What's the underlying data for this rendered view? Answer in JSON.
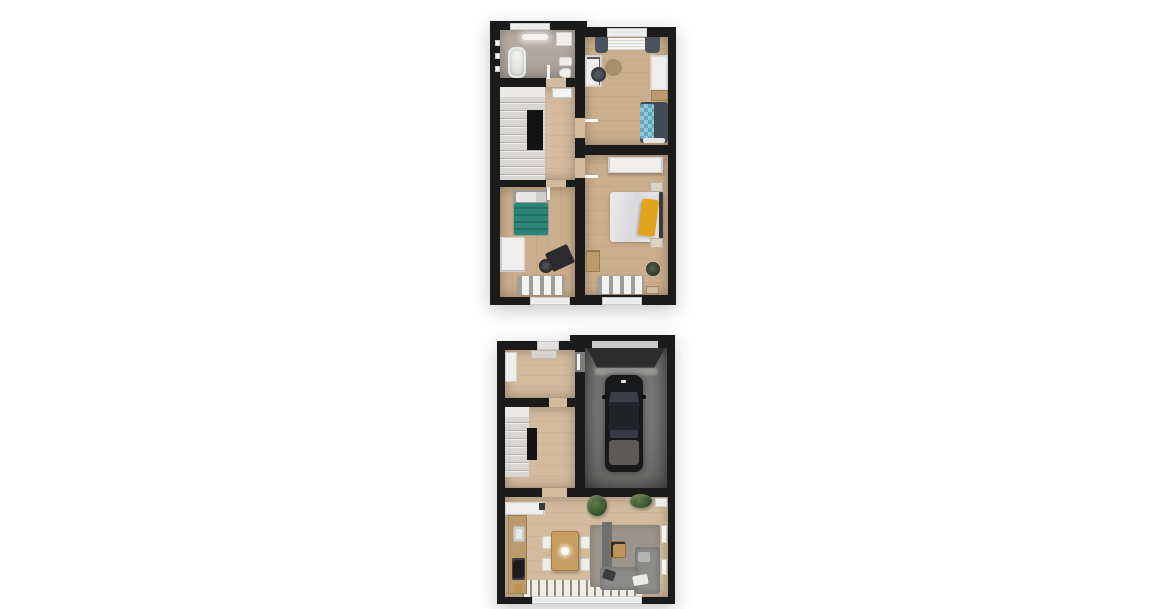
{
  "image_type": "3d-floor-plan-rendering",
  "background": "#ffffff",
  "colors": {
    "wall": "#1b1b1b",
    "wood-floor": "#cbae8d",
    "wood-floor-light": "#d3bb9d",
    "bathroom-floor": "#b1a8a0",
    "stairs": "#d8d6d2",
    "garage-floor": "#6f6f6d",
    "teal-bed": "#2c8577",
    "blue-checker-blanket": "#8fc7d9",
    "yellow-throw": "#e3a51f",
    "sofa-gray": "#8b8b89",
    "rug-gray": "#9b948c",
    "white-furniture": "#efeeec",
    "plant-green": "#47632f",
    "car-body": "#17181a"
  },
  "floors": [
    {
      "name": "upper-floor-plan",
      "rooms": [
        {
          "name": "bathroom",
          "furniture": [
            "bathtub",
            "vanity-cabinet",
            "sink",
            "toilet",
            "radiator",
            "window",
            "ceiling-light"
          ]
        },
        {
          "name": "landing",
          "furniture": [
            "staircase",
            "stairwell-void",
            "radiator"
          ]
        },
        {
          "name": "bedroom-with-teal-bed",
          "furniture": [
            "single-bed-teal",
            "wardrobe",
            "desk",
            "office-chair",
            "striped-rug",
            "window"
          ]
        },
        {
          "name": "bedroom-with-blue-checkered-bed",
          "furniture": [
            "bed-blue-checkered-blanket",
            "desk",
            "office-chair",
            "round-rug",
            "wardrobe",
            "dresser",
            "window-with-curtains"
          ]
        },
        {
          "name": "master-bedroom",
          "furniture": [
            "double-bed-yellow-throw",
            "headboard",
            "wardrobe",
            "nightstand-top",
            "nightstand-bottom",
            "dresser",
            "potted-plant",
            "striped-rug",
            "doormat",
            "window"
          ]
        }
      ]
    },
    {
      "name": "ground-floor-plan",
      "rooms": [
        {
          "name": "entrance-hall",
          "furniture": [
            "closet",
            "doormat",
            "front-door"
          ]
        },
        {
          "name": "staircase-hall",
          "furniture": [
            "stairs",
            "stair-wall"
          ]
        },
        {
          "name": "garage",
          "furniture": [
            "car",
            "garage-door"
          ]
        },
        {
          "name": "kitchen-living-room",
          "furniture": [
            "kitchen-upper-cabinets",
            "kitchen-counter",
            "sink",
            "cooktop",
            "dining-table",
            "dining-chairs-4",
            "pendant-light",
            "hanging-plants",
            "area-rug",
            "tv-panel",
            "coffee-table",
            "corner-sofa",
            "cushions",
            "radiators",
            "terrace-sliding-door"
          ]
        }
      ]
    }
  ]
}
